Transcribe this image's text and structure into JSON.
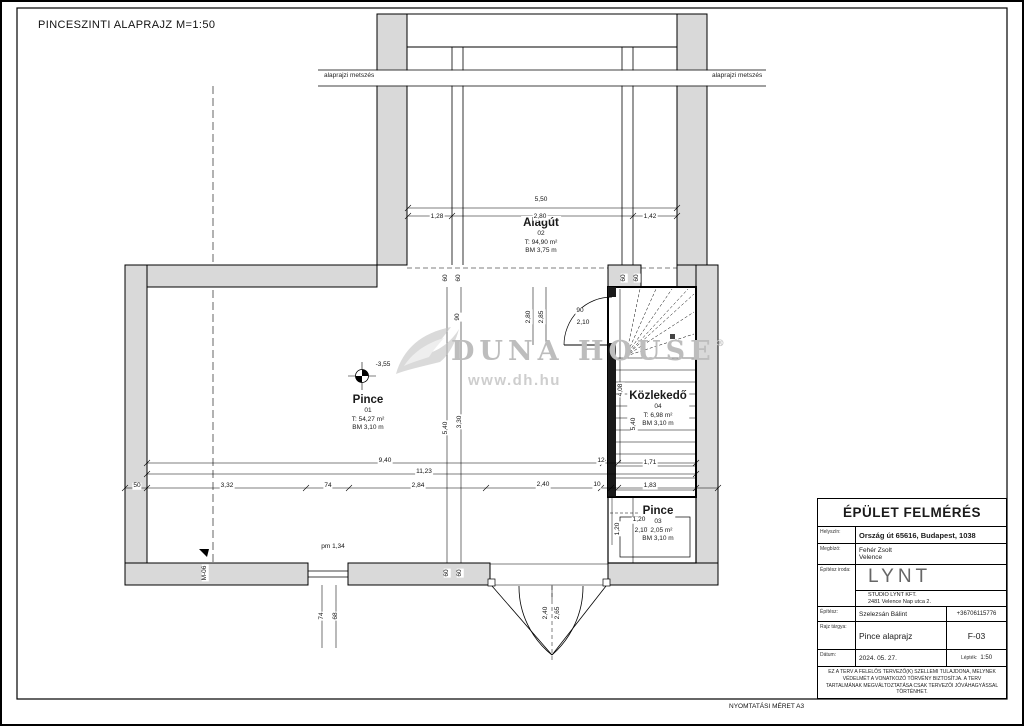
{
  "sheet": {
    "title": "PINCESZINTI ALAPRAJZ M=1:50",
    "print_note": "NYOMTATÁSI MÉRET A3",
    "section_label_left": "alaprajzi metszés",
    "section_label_right": "alaprajzi metszés"
  },
  "watermark": {
    "brand": "DUNA HOUSE",
    "registered": "®",
    "url": "www.dh.hu"
  },
  "plan": {
    "rooms": [
      {
        "name": "Alagút",
        "number": "02",
        "area": "T: 94,90 m²",
        "ceiling": "BM 3,75 m"
      },
      {
        "name": "Pince",
        "number": "01",
        "area": "T: 54,27 m²",
        "ceiling": "BM 3,10 m"
      },
      {
        "name": "Közlekedő",
        "number": "04",
        "area": "T: 6,98 m²",
        "ceiling": "BM 3,10 m"
      },
      {
        "name": "Pince",
        "number": "03",
        "area": "T: 2,05 m²",
        "ceiling": "BM 3,10 m"
      }
    ],
    "dims": [
      {
        "t": "5,50",
        "x": 541,
        "y": 200,
        "r": 0
      },
      {
        "t": "1,28",
        "x": 437,
        "y": 217,
        "r": 0
      },
      {
        "t": "2,80",
        "x": 540,
        "y": 217,
        "r": 0
      },
      {
        "t": "1,42",
        "x": 650,
        "y": 217,
        "r": 0
      },
      {
        "t": "60",
        "x": 446,
        "y": 278,
        "r": -90
      },
      {
        "t": "60",
        "x": 459,
        "y": 278,
        "r": -90
      },
      {
        "t": "60",
        "x": 624,
        "y": 278,
        "r": -90
      },
      {
        "t": "60",
        "x": 637,
        "y": 278,
        "r": -90
      },
      {
        "t": "90",
        "x": 458,
        "y": 317,
        "r": -90
      },
      {
        "t": "2,80",
        "x": 529,
        "y": 317,
        "r": -90
      },
      {
        "t": "2,85",
        "x": 542,
        "y": 317,
        "r": -90
      },
      {
        "t": "90",
        "x": 580,
        "y": 311,
        "r": 0
      },
      {
        "t": "2,10",
        "x": 583,
        "y": 323,
        "r": 0
      },
      {
        "t": "-3,55",
        "x": 383,
        "y": 365,
        "r": 0
      },
      {
        "t": "4,08",
        "x": 621,
        "y": 390,
        "r": -90
      },
      {
        "t": "5,40",
        "x": 446,
        "y": 428,
        "r": -90
      },
      {
        "t": "3,30",
        "x": 460,
        "y": 422,
        "r": -90
      },
      {
        "t": "5,40",
        "x": 634,
        "y": 424,
        "r": -90
      },
      {
        "t": "9,40",
        "x": 385,
        "y": 461,
        "r": 0
      },
      {
        "t": "12",
        "x": 601,
        "y": 461,
        "r": 0
      },
      {
        "t": "1,71",
        "x": 650,
        "y": 463,
        "r": 0
      },
      {
        "t": "11,23",
        "x": 424,
        "y": 472,
        "r": 0
      },
      {
        "t": "50",
        "x": 137,
        "y": 486,
        "r": 0
      },
      {
        "t": "3,32",
        "x": 227,
        "y": 486,
        "r": 0
      },
      {
        "t": "74",
        "x": 328,
        "y": 486,
        "r": 0
      },
      {
        "t": "2,84",
        "x": 418,
        "y": 486,
        "r": 0
      },
      {
        "t": "2,40",
        "x": 543,
        "y": 485,
        "r": 0
      },
      {
        "t": "10",
        "x": 597,
        "y": 485,
        "r": 0
      },
      {
        "t": "1,83",
        "x": 650,
        "y": 486,
        "r": 0
      },
      {
        "t": "1,20",
        "x": 639,
        "y": 520,
        "r": 0
      },
      {
        "t": "2,10",
        "x": 641,
        "y": 531,
        "r": 0
      },
      {
        "t": "1,20",
        "x": 618,
        "y": 529,
        "r": -90
      },
      {
        "t": "pm 1,34",
        "x": 333,
        "y": 547,
        "r": 0
      },
      {
        "t": "M-06",
        "x": 205,
        "y": 573,
        "r": -90
      },
      {
        "t": "60",
        "x": 447,
        "y": 573,
        "r": -90
      },
      {
        "t": "60",
        "x": 460,
        "y": 573,
        "r": -90
      },
      {
        "t": "74",
        "x": 322,
        "y": 616,
        "r": -90
      },
      {
        "t": "68",
        "x": 336,
        "y": 616,
        "r": -90
      },
      {
        "t": "2,40",
        "x": 546,
        "y": 613,
        "r": -90
      },
      {
        "t": "2,65",
        "x": 558,
        "y": 613,
        "r": -90
      }
    ]
  },
  "titleblock": {
    "header": "ÉPÜLET FELMÉRÉS",
    "location_label": "Helyszín:",
    "location": "Ország út 65616, Budapest, 1038",
    "client_label": "Megbízó:",
    "client_name": "Fehér Zsolt",
    "client_city": "Velence",
    "office_label": "Építész iroda:",
    "office_logo": "LYNT",
    "office_firm": "STUDIO LYNT KFT.",
    "office_addr": "2481 Velence Nap utca 2.",
    "architect_label": "Építész:",
    "architect": "Szelezsán Bálint",
    "phone": "+36706115776",
    "subject_label": "Rajz tárgya:",
    "subject": "Pince alaprajz",
    "sheet_no": "F-03",
    "date_label": "Dátum:",
    "date": "2024. 05. 27.",
    "scale_label": "Lépték:",
    "scale": "1:50",
    "disclaimer": "EZ A TERV A FELELŐS TERVEZŐ(K) SZELLEMI TULAJDONA, MELYNEK VÉDELMÉT A VONATKOZÓ TÖRVÉNY BIZTOSÍTJA. A TERV TARTALMÁNAK MEGVÁLTOZTATÁSA CSAK TERVEZŐI JÓVÁHAGYÁSSAL TÖRTÉNHET."
  }
}
